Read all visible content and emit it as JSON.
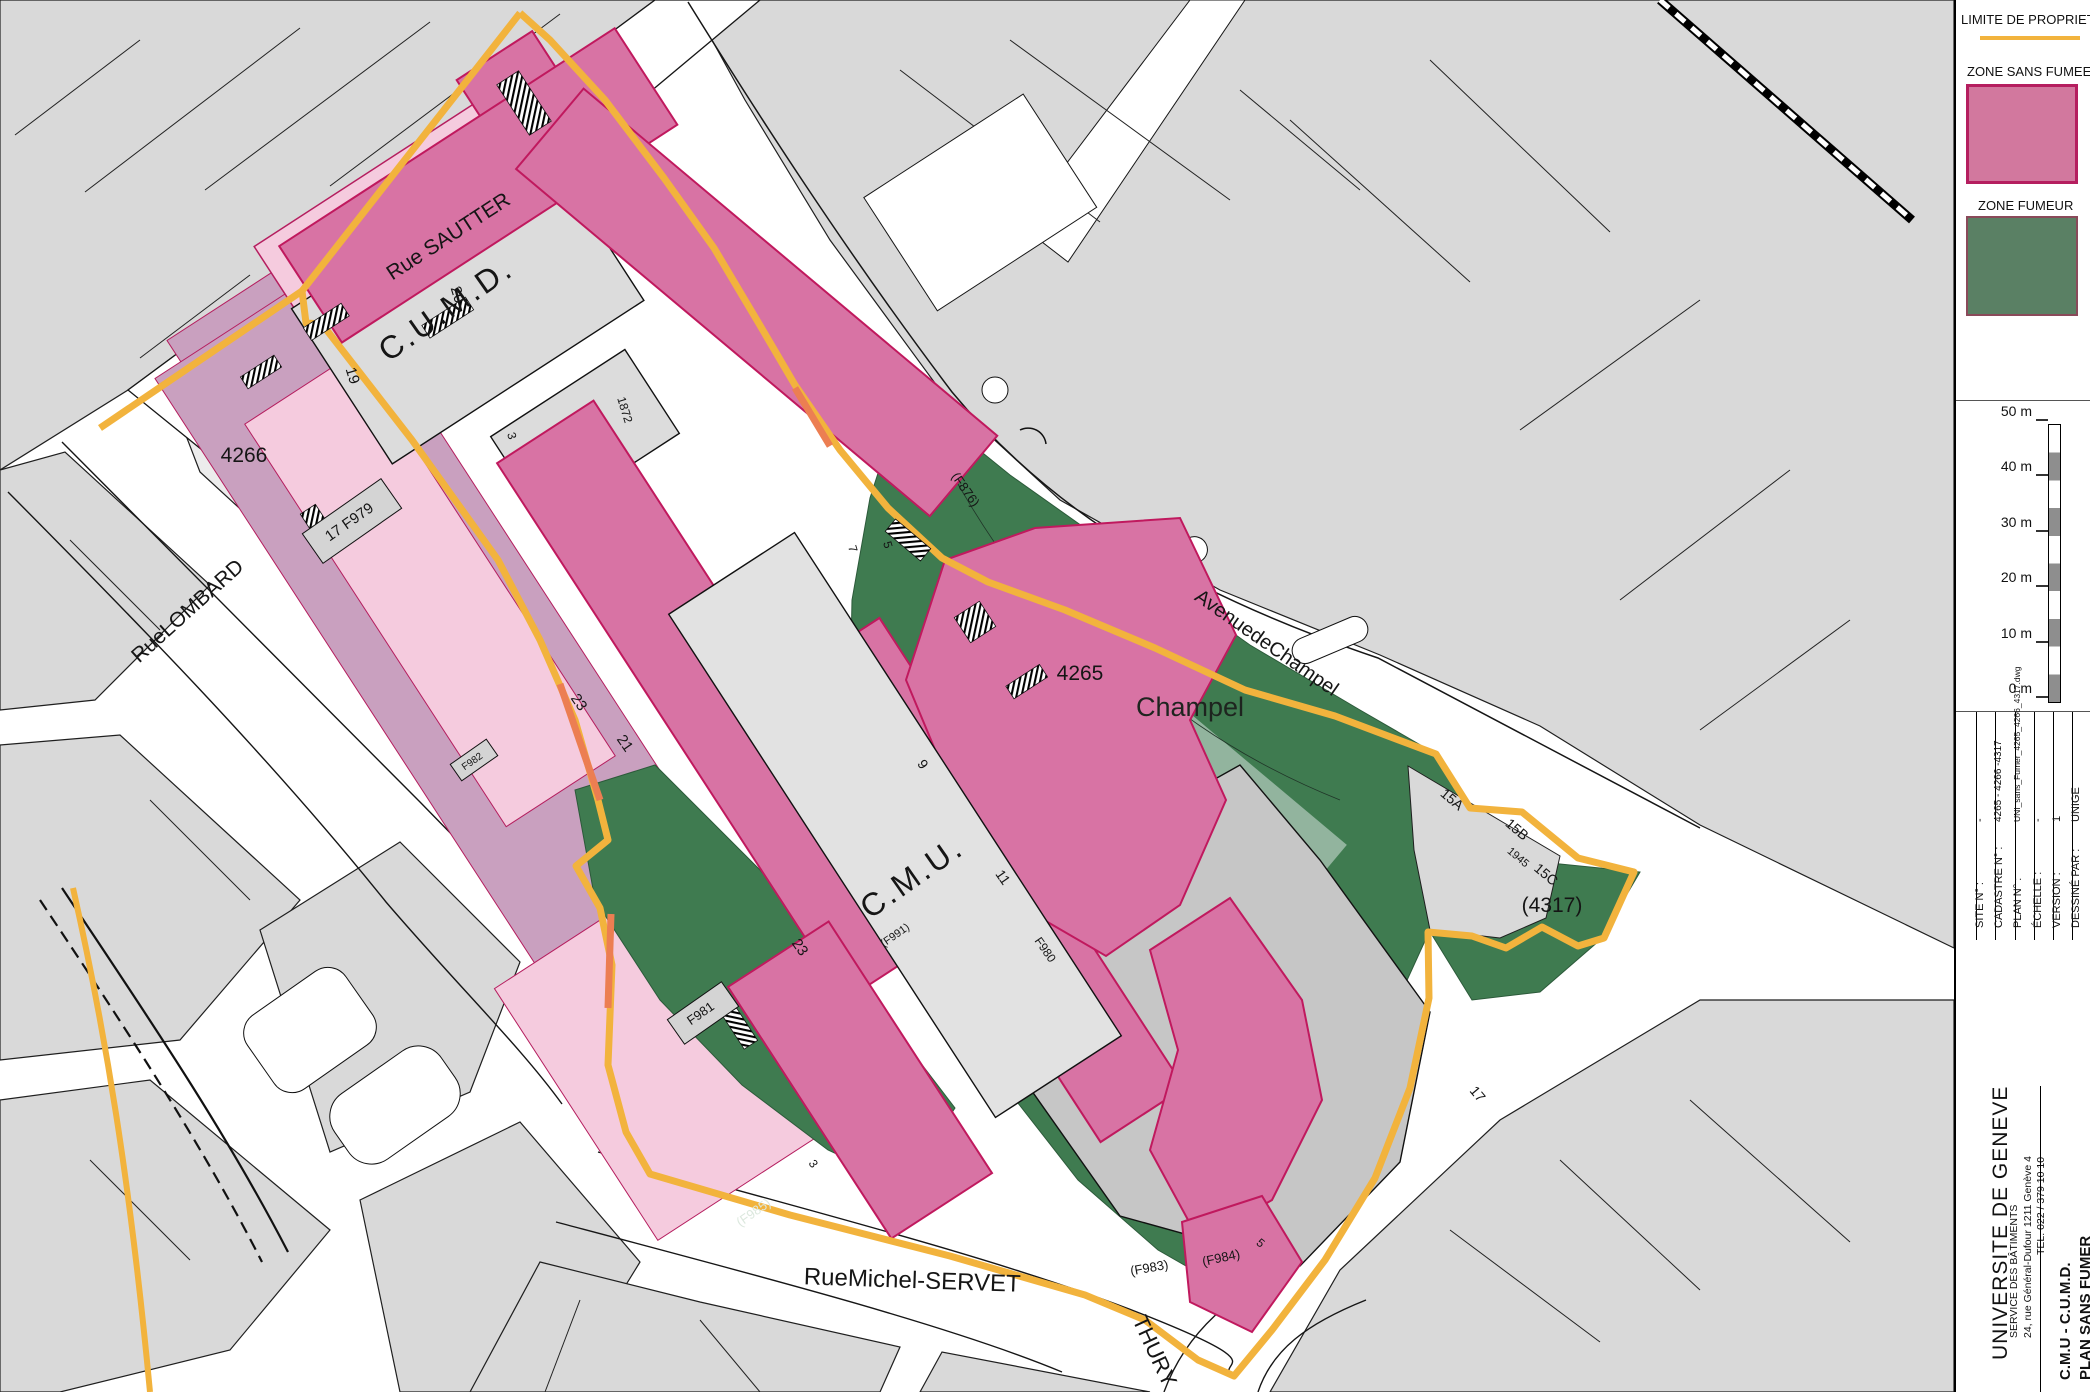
{
  "legend": {
    "limite_label": "LIMITE DE PROPRIET",
    "zone_sans_fumee_label": "ZONE SANS FUMEE",
    "zone_fumeur_label": "ZONE FUMEUR",
    "colors": {
      "boundary_yellow": "#F2B33D",
      "boundary_orange_overlap": "#EC7E52",
      "zone_sans_fumee_fill": "#D2789E",
      "zone_sans_fumee_border": "#B51E5F",
      "zone_fumeur_fill": "#5A8064",
      "zone_fumeur_border": "#8A4A5A"
    }
  },
  "scalebar": {
    "labels": [
      "50 m",
      "40 m",
      "30 m",
      "20 m",
      "10 m",
      "0 m"
    ]
  },
  "titleblock": {
    "fields": [
      {
        "label": "SITE N° :",
        "value": "-"
      },
      {
        "label": "CADASTRE N° :",
        "value": "4265 - 4266 -4317"
      },
      {
        "label": "PLAN N° :",
        "value": "UNI_sans_Fumer_4265_4266_4317.dwg"
      },
      {
        "label": "ÉCHELLE :",
        "value": "-"
      },
      {
        "label": "VERSION :",
        "value": "1"
      },
      {
        "label": "DESSINÉ PAR :",
        "value": "UNIGE"
      },
      {
        "label": "DATE :",
        "value": "11.06.2024"
      }
    ],
    "org": "UNIVERSITE DE GENEVE",
    "service": "SERVICE  DES  BÂTIMENTS",
    "address": "24, rue Général-Dufour   1211 Genève 4",
    "tel": "TEL. 022 / 379 10 10",
    "project": "C.M.U - C.U.M.D.",
    "plan": "PLAN SANS FUMER",
    "dash": "-"
  },
  "map": {
    "labels": [
      {
        "id": "rue-sautter",
        "text": "Rue SAUTTER",
        "x": 452,
        "y": 242,
        "rot": -33,
        "size": 21
      },
      {
        "id": "rue-lombard",
        "text": "RueLOMBARD",
        "x": 192,
        "y": 616,
        "rot": -42,
        "size": 21
      },
      {
        "id": "avenue-de-champel",
        "text": "AvenuedeChampel",
        "x": 1263,
        "y": 648,
        "rot": 35,
        "size": 20
      },
      {
        "id": "rue-michel-servet",
        "text": "RueMichel-SERVET",
        "x": 912,
        "y": 1288,
        "rot": 2,
        "size": 24
      },
      {
        "id": "thury",
        "text": "THURY",
        "x": 1148,
        "y": 1354,
        "rot": 65,
        "size": 22
      },
      {
        "id": "cumd",
        "text": "C.U.M.D.",
        "x": 452,
        "y": 318,
        "rot": -35,
        "size": 32,
        "ls": 3
      },
      {
        "id": "cmu",
        "text": "C.M.U.",
        "x": 918,
        "y": 886,
        "rot": -35,
        "size": 32,
        "ls": 3
      },
      {
        "id": "f991",
        "text": "(F991)",
        "x": 897,
        "y": 938,
        "rot": -35,
        "size": 11
      },
      {
        "id": "champel",
        "text": "Champel",
        "x": 1190,
        "y": 716,
        "rot": 0,
        "size": 27,
        "color": "#1e241f"
      },
      {
        "id": "parcel-4266",
        "text": "4266",
        "x": 244,
        "y": 462,
        "rot": 0,
        "size": 21
      },
      {
        "id": "parcel-4265",
        "text": "4265",
        "x": 1080,
        "y": 680,
        "rot": 0,
        "size": 21
      },
      {
        "id": "parcel-4317",
        "text": "(4317)",
        "x": 1552,
        "y": 912,
        "rot": 0,
        "size": 21
      },
      {
        "id": "f876",
        "text": "(F876)",
        "x": 962,
        "y": 492,
        "rot": 55,
        "size": 13
      },
      {
        "id": "f979",
        "text": "17 F979",
        "x": 352,
        "y": 526,
        "rot": -35,
        "size": 15
      },
      {
        "id": "f981",
        "text": "F981",
        "x": 703,
        "y": 1017,
        "rot": -35,
        "size": 13
      },
      {
        "id": "f982",
        "text": "F982",
        "x": 474,
        "y": 764,
        "rot": -35,
        "size": 10
      },
      {
        "id": "f985",
        "text": "(F985)",
        "x": 756,
        "y": 1216,
        "rot": -35,
        "size": 13,
        "color": "#dce8de"
      },
      {
        "id": "f983",
        "text": "(F983)",
        "x": 1150,
        "y": 1272,
        "rot": -10,
        "size": 13
      },
      {
        "id": "f984",
        "text": "(F984)",
        "x": 1222,
        "y": 1262,
        "rot": -12,
        "size": 13
      },
      {
        "id": "f980",
        "text": "F980",
        "x": 1042,
        "y": 952,
        "rot": 55,
        "size": 12
      },
      {
        "id": "n20",
        "text": "20",
        "x": 453,
        "y": 296,
        "rot": 73,
        "size": 15
      },
      {
        "id": "n19",
        "text": "19",
        "x": 348,
        "y": 377,
        "rot": 73,
        "size": 15
      },
      {
        "id": "n3a",
        "text": "3",
        "x": 508,
        "y": 437,
        "rot": 73,
        "size": 12
      },
      {
        "id": "n1872",
        "text": "1872",
        "x": 621,
        "y": 411,
        "rot": 73,
        "size": 12
      },
      {
        "id": "n7",
        "text": "7",
        "x": 849,
        "y": 550,
        "rot": 73,
        "size": 12
      },
      {
        "id": "n5a",
        "text": "5",
        "x": 884,
        "y": 546,
        "rot": 73,
        "size": 12
      },
      {
        "id": "n9",
        "text": "9",
        "x": 919,
        "y": 767,
        "rot": 55,
        "size": 14
      },
      {
        "id": "n11",
        "text": "11",
        "x": 999,
        "y": 880,
        "rot": 55,
        "size": 14
      },
      {
        "id": "n23a",
        "text": "23",
        "x": 575,
        "y": 705,
        "rot": 55,
        "size": 15
      },
      {
        "id": "n21",
        "text": "21",
        "x": 621,
        "y": 746,
        "rot": 55,
        "size": 15
      },
      {
        "id": "n23b",
        "text": "23",
        "x": 796,
        "y": 950,
        "rot": 55,
        "size": 15
      },
      {
        "id": "n15a",
        "text": "15A",
        "x": 1449,
        "y": 803,
        "rot": 40,
        "size": 14
      },
      {
        "id": "n15b",
        "text": "15B",
        "x": 1514,
        "y": 833,
        "rot": 40,
        "size": 14
      },
      {
        "id": "n1945",
        "text": "1945",
        "x": 1516,
        "y": 860,
        "rot": 40,
        "size": 11
      },
      {
        "id": "n15c",
        "text": "15C",
        "x": 1543,
        "y": 878,
        "rot": 40,
        "size": 14
      },
      {
        "id": "n17",
        "text": "17",
        "x": 1474,
        "y": 1097,
        "rot": 50,
        "size": 14
      },
      {
        "id": "n3b",
        "text": "3",
        "x": 810,
        "y": 1166,
        "rot": 55,
        "size": 12
      },
      {
        "id": "n5b",
        "text": "5",
        "x": 1258,
        "y": 1246,
        "rot": 40,
        "size": 12
      }
    ]
  }
}
